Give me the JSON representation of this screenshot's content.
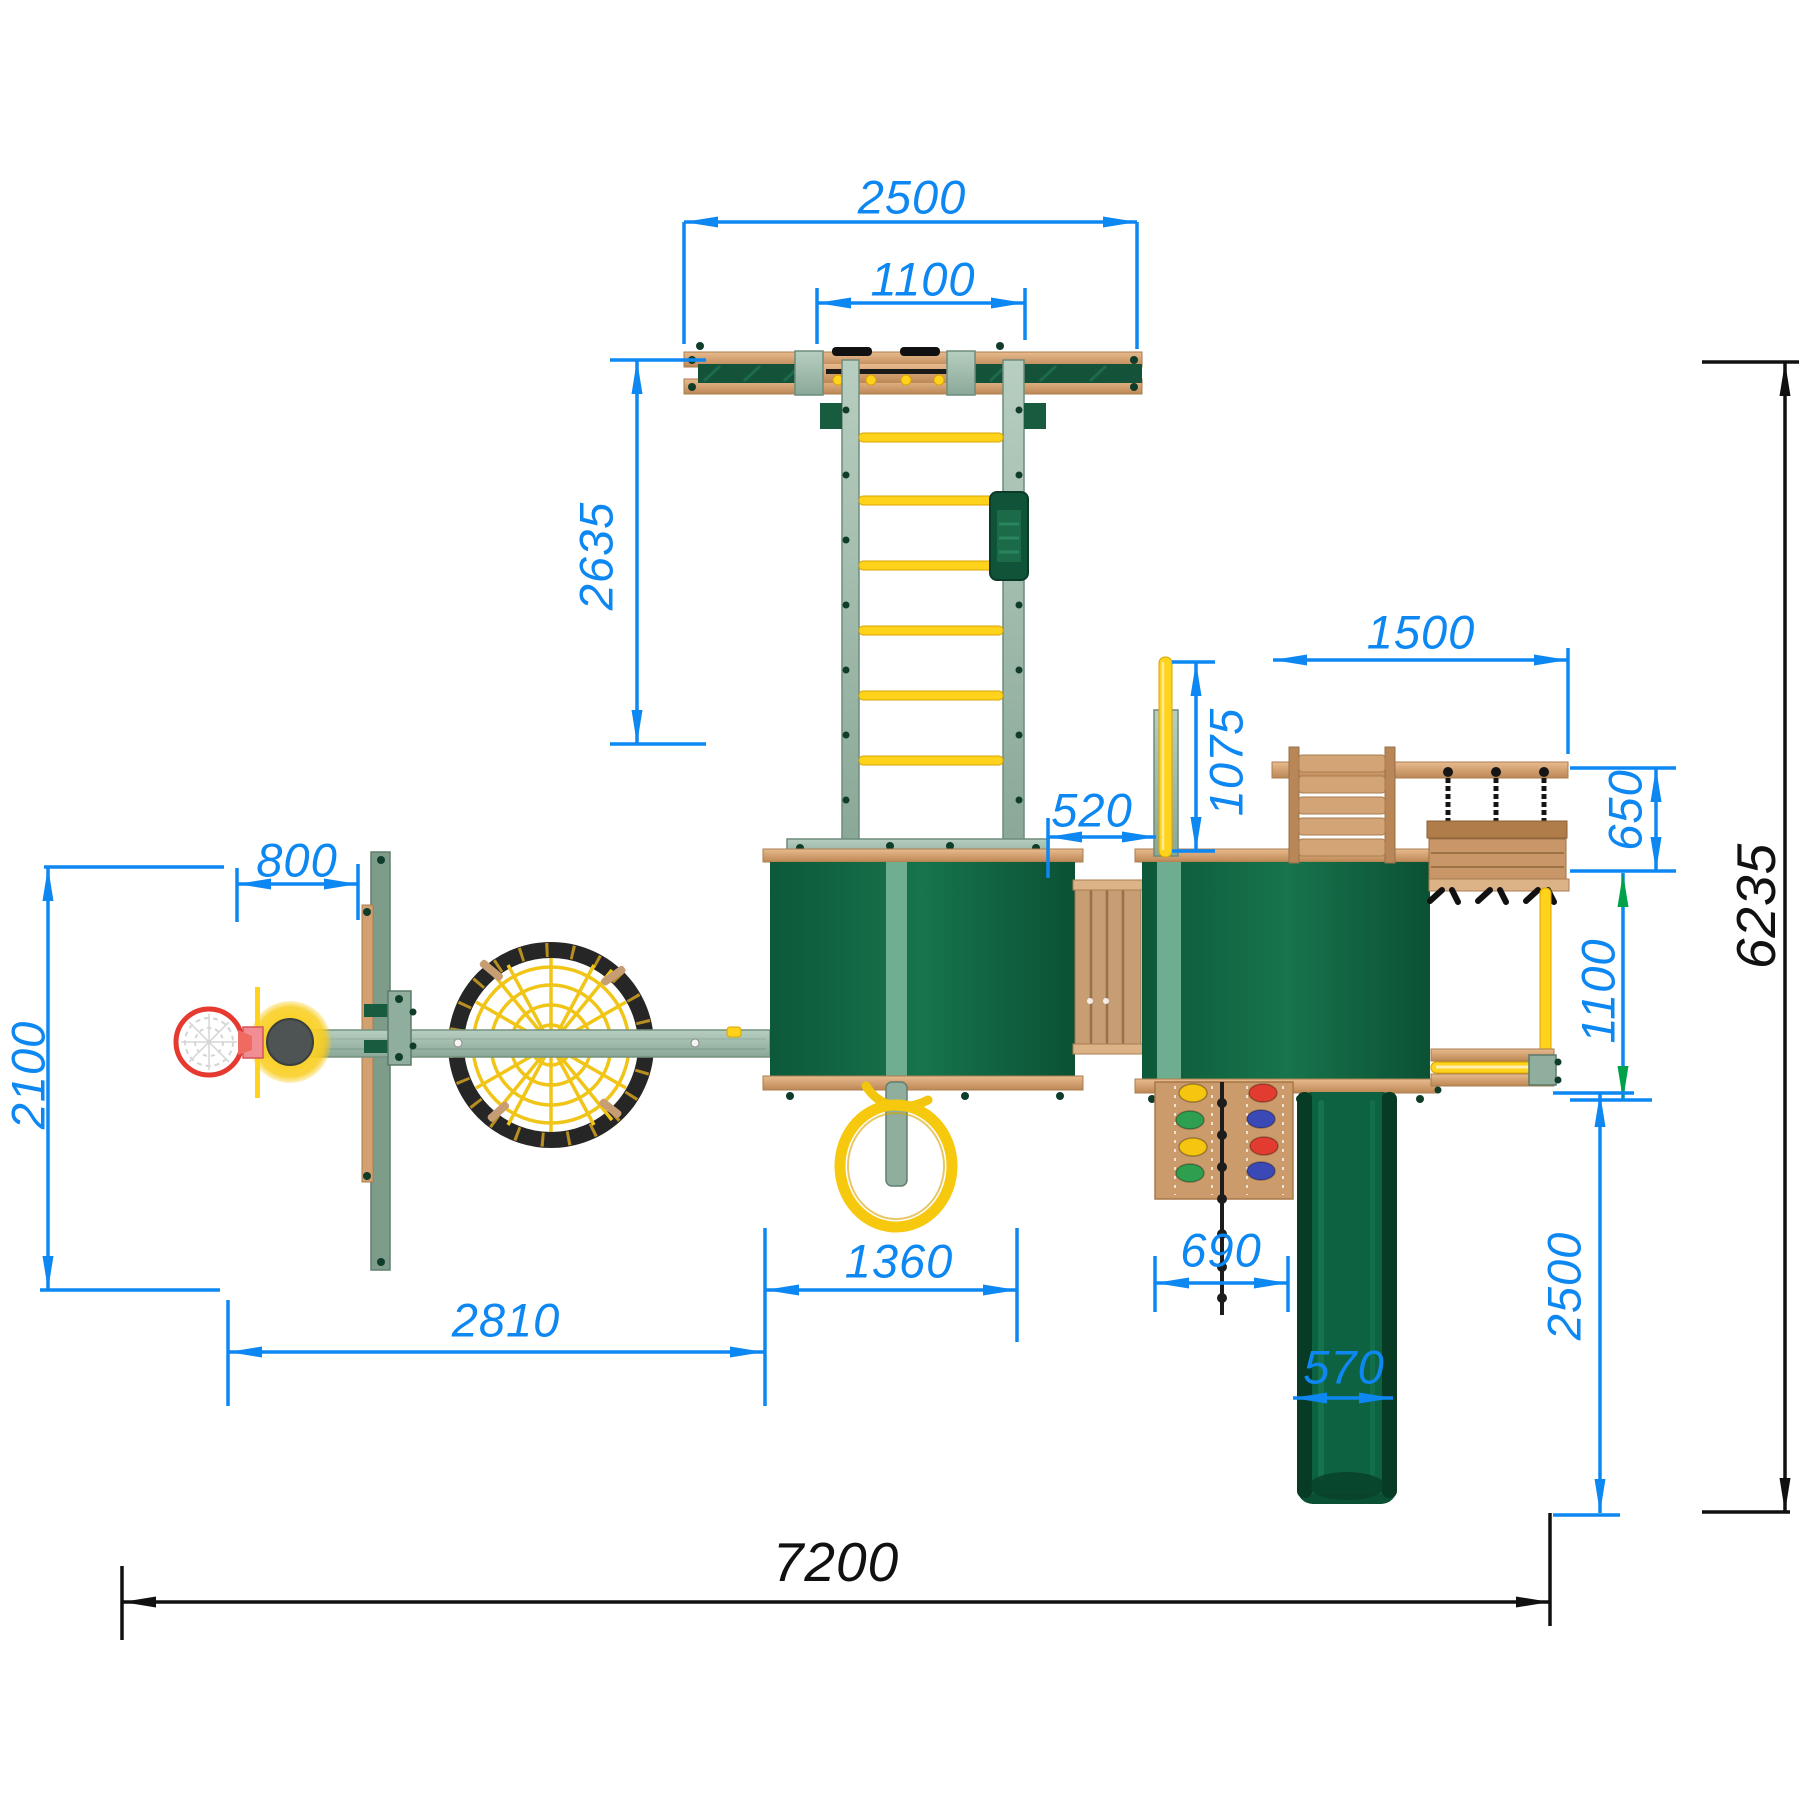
{
  "dimensions": {
    "beam_span": "2500",
    "monkey_bars_span": "1100",
    "ladder_run": "2635",
    "swing_bay_width": "1500",
    "pole_drop": "1075",
    "tower_gap": "520",
    "swing_seat_depth": "650",
    "hoop_offset": "800",
    "left_wing_depth": "2100",
    "bar_drop": "1100",
    "slide_run": "2500",
    "overall_depth": "6235",
    "left_span": "2810",
    "tower_width": "1360",
    "rock_wall_width": "690",
    "slide_width": "570",
    "overall_width": "7200"
  },
  "colors": {
    "dim_blue": "#0d87f2",
    "dim_black": "#111111",
    "dim_green_arrow": "#00a14b",
    "tower_green": "#0e6a45",
    "slide_green": "#0a5034",
    "wood": "#d3a072",
    "painted_sage": "#a3bfae",
    "accent_yellow": "#ffd21c",
    "hoop_red": "#e63a30"
  }
}
